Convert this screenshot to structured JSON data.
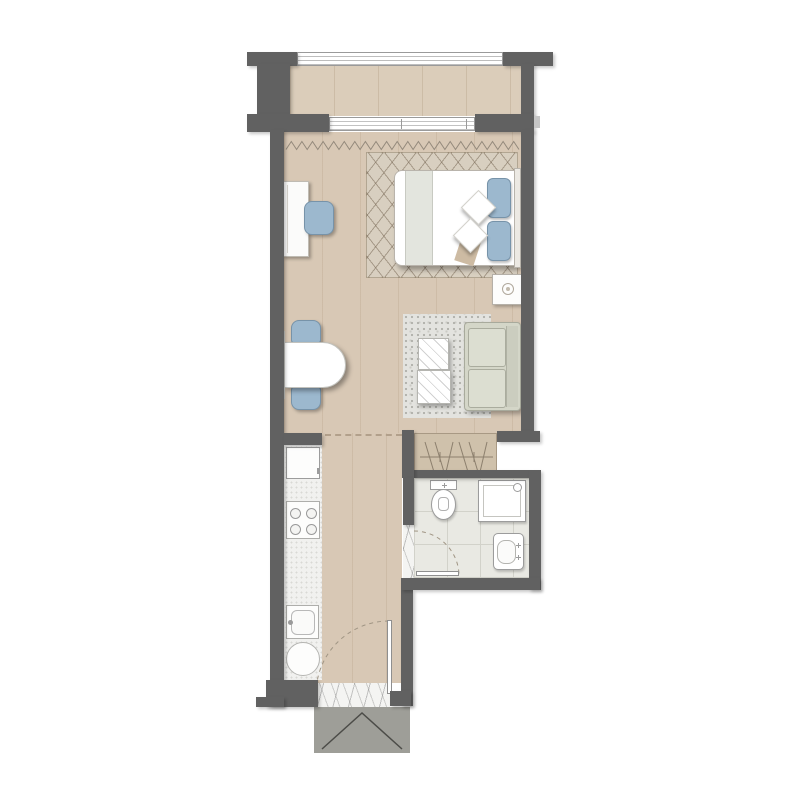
{
  "plan": {
    "type": "studio-apartment-floor-plan",
    "has_text_labels": false,
    "colors": {
      "wall": "#616161",
      "wallTab": "#c6c6c6",
      "wood": "#d8c8b5",
      "balcony": "#dbcdba",
      "rugBed": "#d8cfc0",
      "rugLiving": "#e3e3df",
      "rugLivingDot": "#b2b2ac",
      "bathFloor": "#e9e9e3",
      "tileLine": "#d2d2ca",
      "blue": "#9cb8ce",
      "blueBorder": "#7793a9",
      "sofa": "#d4d6c8",
      "sofaCushion": "#dcded1",
      "sofaLine": "#a8aa9c",
      "counter": "#f1f1ef",
      "wardrobe": "#cfc1ab",
      "wardrobeLine": "#8c7f6d",
      "landing": "#9e9e98",
      "landingLine": "#4c4c48",
      "fixture": "#ffffff",
      "fixtureLine": "#9c9c9c",
      "curtain": "#93897b",
      "dash": "#b2a08b"
    },
    "rooms": [
      {
        "id": "balcony",
        "name": "balcony with glass railing"
      },
      {
        "id": "bedroom",
        "name": "sleeping area"
      },
      {
        "id": "living",
        "name": "living-dining area"
      },
      {
        "id": "kitchen",
        "name": "kitchenette strip"
      },
      {
        "id": "hallway",
        "name": "entrance hallway"
      },
      {
        "id": "wardrobe",
        "name": "built-in wardrobe"
      },
      {
        "id": "bathroom",
        "name": "bathroom"
      }
    ],
    "furniture": [
      {
        "id": "bed",
        "name": "double bed with two blue pillows, two white cushions and throw",
        "room": "bedroom"
      },
      {
        "id": "rug-bedroom",
        "name": "diamond-pattern area rug",
        "room": "bedroom"
      },
      {
        "id": "desk",
        "name": "wall desk",
        "room": "bedroom"
      },
      {
        "id": "desk-chair",
        "name": "blue desk chair",
        "room": "bedroom"
      },
      {
        "id": "nightstand",
        "name": "nightstand with lamp",
        "room": "bedroom"
      },
      {
        "id": "dining-table",
        "name": "wall-mounted half-oval dining table",
        "room": "living"
      },
      {
        "id": "dining-chairs",
        "name": "two blue dining chairs",
        "room": "living"
      },
      {
        "id": "rug-living",
        "name": "speckled gray rug",
        "room": "living"
      },
      {
        "id": "coffee-tables",
        "name": "two square glass coffee tables",
        "room": "living"
      },
      {
        "id": "sofa",
        "name": "two-seat sofa",
        "room": "living"
      },
      {
        "id": "fridge",
        "name": "refrigerator",
        "room": "kitchen"
      },
      {
        "id": "cooktop",
        "name": "four-burner cooktop",
        "room": "kitchen"
      },
      {
        "id": "kitchen-sink",
        "name": "kitchen sink",
        "room": "kitchen"
      },
      {
        "id": "washer",
        "name": "round appliance / washer",
        "room": "kitchen"
      },
      {
        "id": "toilet",
        "name": "toilet",
        "room": "bathroom"
      },
      {
        "id": "shower",
        "name": "shower enclosure",
        "room": "bathroom"
      },
      {
        "id": "bath-sink",
        "name": "washbasin",
        "room": "bathroom"
      }
    ],
    "fixtures": [
      {
        "id": "railing",
        "name": "balcony railing"
      },
      {
        "id": "sliding-door",
        "name": "sliding glass balcony door"
      },
      {
        "id": "curtain",
        "name": "curtain zigzag symbol"
      },
      {
        "id": "entry-door",
        "name": "entrance door with swing arc"
      },
      {
        "id": "bath-door",
        "name": "bathroom door with swing arc"
      },
      {
        "id": "marble-threshold",
        "name": "marble entry threshold"
      },
      {
        "id": "landing",
        "name": "exterior landing step with chevron"
      },
      {
        "id": "divider",
        "name": "dashed zone divider line"
      }
    ]
  }
}
